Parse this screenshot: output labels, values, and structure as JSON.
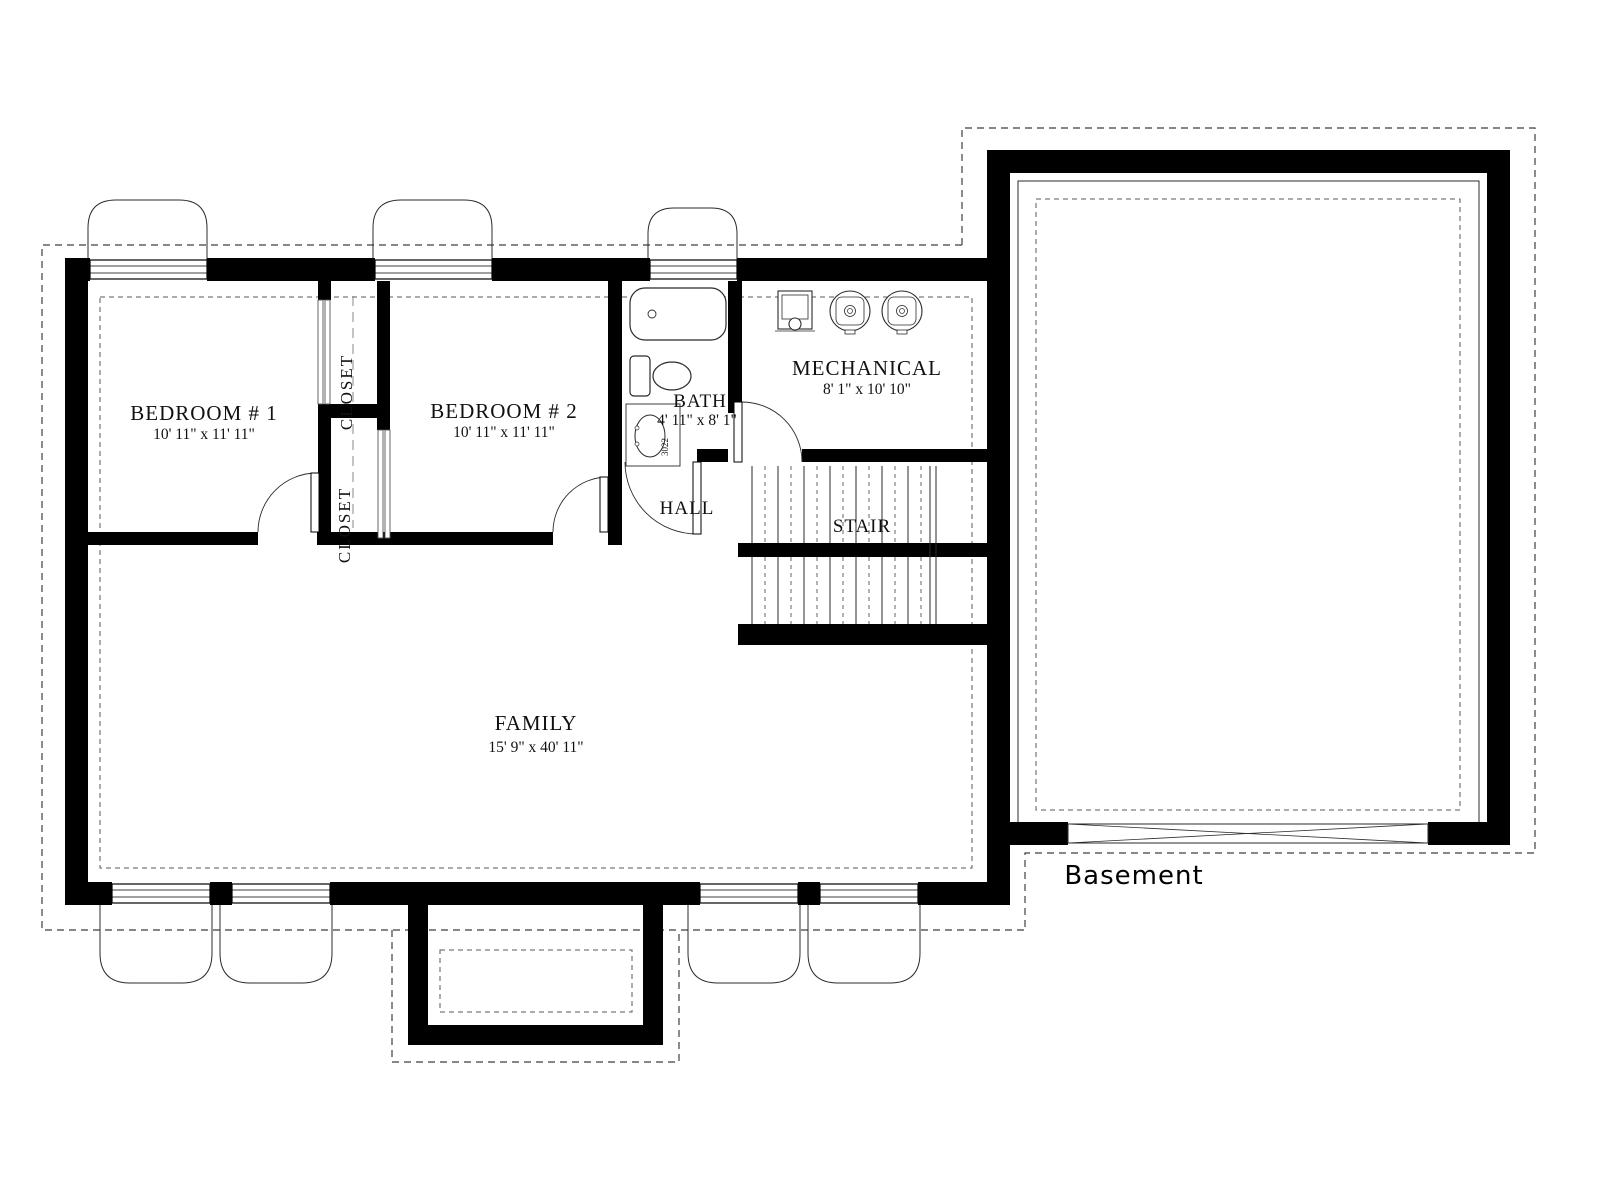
{
  "title": "Basement",
  "rooms": {
    "bedroom1": {
      "name": "BEDROOM # 1",
      "dims": "10' 11\" x 11' 11\""
    },
    "bedroom2": {
      "name": "BEDROOM # 2",
      "dims": "10' 11\" x 11' 11\""
    },
    "bath": {
      "name": "BATH",
      "dims": "4' 11\" x 8' 1\""
    },
    "mechanical": {
      "name": "MECHANICAL",
      "dims": "8' 1\" x 10' 10\""
    },
    "family": {
      "name": "FAMILY",
      "dims": "15' 9\" x 40' 11\""
    },
    "hall": {
      "name": "HALL"
    },
    "stair": {
      "name": "STAIR"
    },
    "closet_upper": {
      "name": "CLOSET"
    },
    "closet_lower": {
      "name": "CLOSET"
    }
  },
  "fixtures": {
    "vanity_code": "3022"
  },
  "colors": {
    "wall": "#000000",
    "background": "#ffffff",
    "line": "#2b2b2b",
    "dash": "#4a4a4a"
  }
}
